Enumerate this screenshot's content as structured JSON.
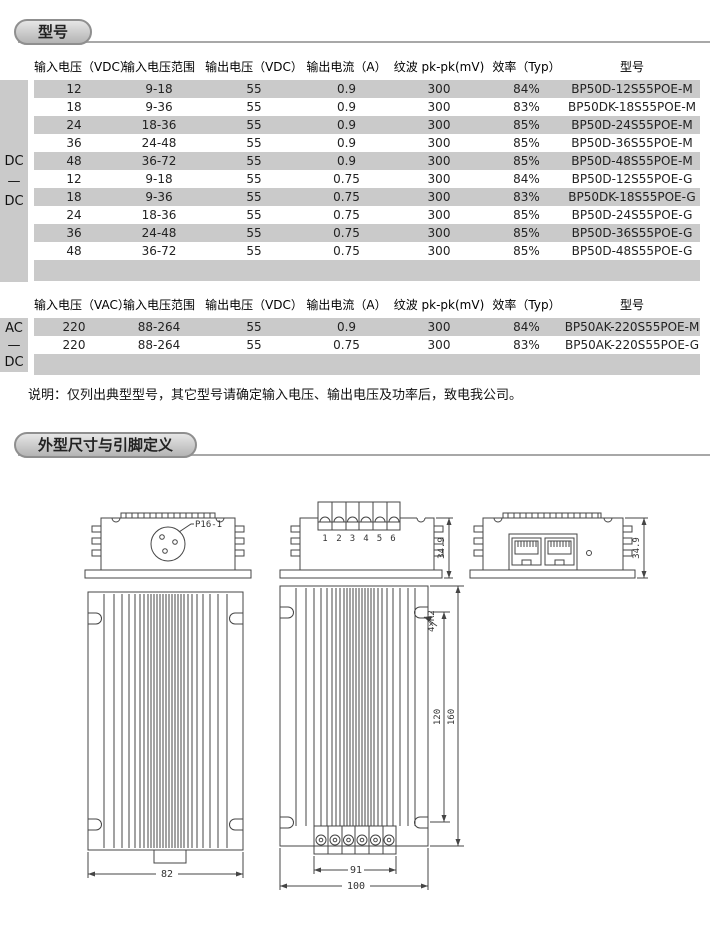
{
  "section_models": {
    "tab_label": "型号",
    "dc_table": {
      "type_label": [
        "DC",
        "—",
        "DC"
      ],
      "headers": [
        "输入电压（VDC）",
        "输入电压范围",
        "输出电压（VDC）",
        "输出电流（A）",
        "纹波 pk-pk(mV)",
        "效率（Typ）",
        "型号"
      ],
      "rows": [
        [
          "12",
          "9-18",
          "55",
          "0.9",
          "300",
          "84%",
          "BP50D-12S55POE-M"
        ],
        [
          "18",
          "9-36",
          "55",
          "0.9",
          "300",
          "83%",
          "BP50DK-18S55POE-M"
        ],
        [
          "24",
          "18-36",
          "55",
          "0.9",
          "300",
          "85%",
          "BP50D-24S55POE-M"
        ],
        [
          "36",
          "24-48",
          "55",
          "0.9",
          "300",
          "85%",
          "BP50D-36S55POE-M"
        ],
        [
          "48",
          "36-72",
          "55",
          "0.9",
          "300",
          "85%",
          "BP50D-48S55POE-M"
        ],
        [
          "12",
          "9-18",
          "55",
          "0.75",
          "300",
          "84%",
          "BP50D-12S55POE-G"
        ],
        [
          "18",
          "9-36",
          "55",
          "0.75",
          "300",
          "83%",
          "BP50DK-18S55POE-G"
        ],
        [
          "24",
          "18-36",
          "55",
          "0.75",
          "300",
          "85%",
          "BP50D-24S55POE-G"
        ],
        [
          "36",
          "24-48",
          "55",
          "0.75",
          "300",
          "85%",
          "BP50D-36S55POE-G"
        ],
        [
          "48",
          "36-72",
          "55",
          "0.75",
          "300",
          "85%",
          "BP50D-48S55POE-G"
        ]
      ]
    },
    "ac_table": {
      "type_label": [
        "AC",
        "—",
        "DC"
      ],
      "headers": [
        "输入电压（VAC）",
        "输入电压范围",
        "输出电压（VDC）",
        "输出电流（A）",
        "纹波 pk-pk(mV)",
        "效率（Typ）",
        "型号"
      ],
      "rows": [
        [
          "220",
          "88-264",
          "55",
          "0.9",
          "300",
          "84%",
          "BP50AK-220S55POE-M"
        ],
        [
          "220",
          "88-264",
          "55",
          "0.75",
          "300",
          "83%",
          "BP50AK-220S55POE-G"
        ]
      ]
    },
    "note": "说明：仅列出典型型号，其它型号请确定输入电压、输出电压及功率后，致电我公司。"
  },
  "section_dimensions": {
    "tab_label": "外型尺寸与引脚定义",
    "drawing": {
      "connector_label": "P16-1",
      "terminal_numbers": [
        "1",
        "2",
        "3",
        "4",
        "5",
        "6"
      ],
      "side_height": "34.9",
      "fin_width": "82",
      "terminal_width": "91",
      "total_width": "100",
      "slot_pitch": "120",
      "total_length": "160",
      "corner_slot": "4×R2"
    }
  },
  "colors": {
    "stripe_gray": "#cacaca",
    "tab_border_gray": "#8f8f8f",
    "rule_gray": "#a8a8a8"
  }
}
